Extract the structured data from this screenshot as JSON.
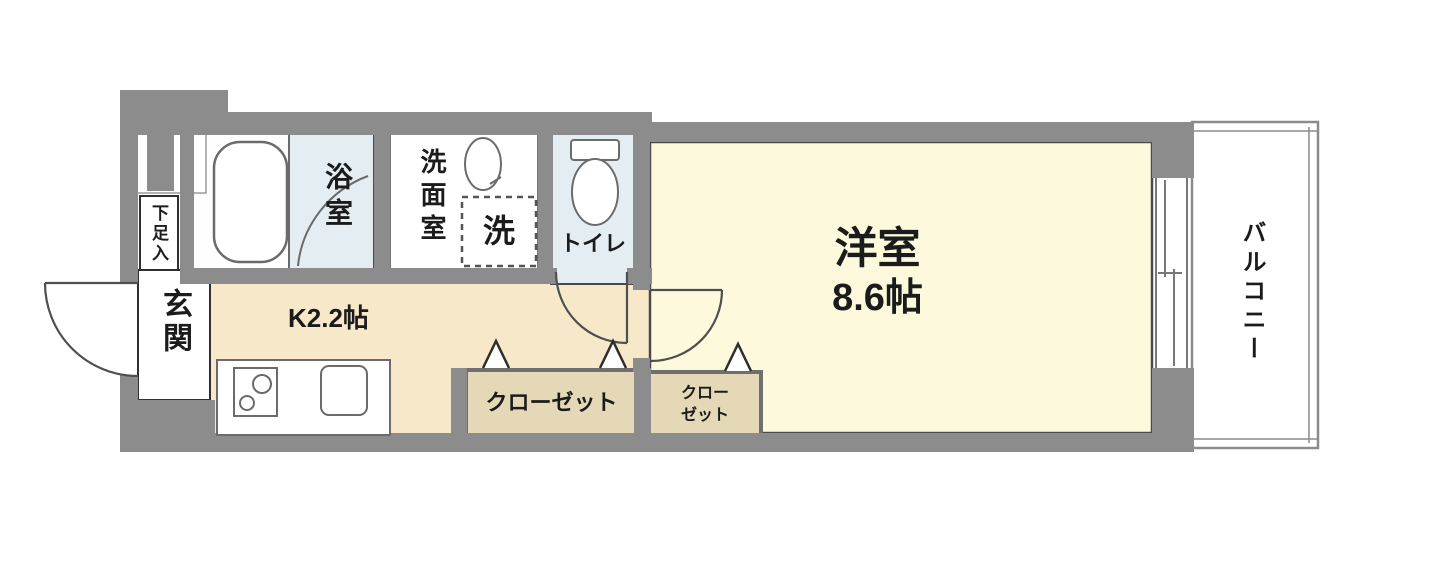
{
  "floor_plan": {
    "rooms": {
      "entrance": {
        "label": "玄関"
      },
      "shoe_storage": {
        "label": "下足入"
      },
      "bathroom": {
        "label": "浴室"
      },
      "washroom": {
        "label": "洗面室"
      },
      "washer_space": {
        "label": "洗"
      },
      "toilet": {
        "label": "トイレ"
      },
      "kitchen": {
        "label": "K2.2帖"
      },
      "main_room": {
        "label": "洋室",
        "size": "8.6帖"
      },
      "closet_large": {
        "label": "クローゼット"
      },
      "closet_small": {
        "label_line1": "クロー",
        "label_line2": "ゼット"
      },
      "balcony": {
        "label": "バルコニー"
      }
    },
    "colors": {
      "wall": "#8c8c8c",
      "wet_room": "#e4eef2",
      "kitchen": "#f7e8ca",
      "living": "#fcf9dc",
      "closet": "#e5d8b6",
      "background": "#ffffff"
    }
  }
}
